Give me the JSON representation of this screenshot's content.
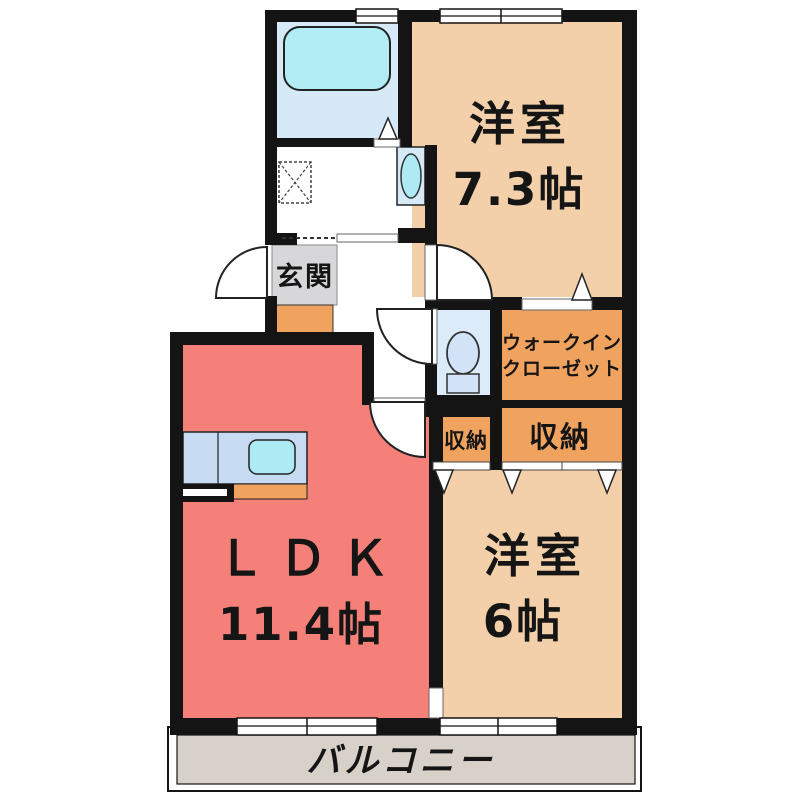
{
  "floor_plan": {
    "rooms": {
      "western_room_73": {
        "name": "洋室",
        "size": "7.3帖"
      },
      "western_room_6": {
        "name": "洋室",
        "size": "6帖"
      },
      "ldk": {
        "name": "ＬＤＫ",
        "size": "11.4帖"
      },
      "walk_in_closet": {
        "name_line1": "ウォークイン",
        "name_line2": "クローゼット"
      },
      "entrance": {
        "name": "玄関"
      },
      "storage_small": {
        "name": "収納"
      },
      "storage_large": {
        "name": "収納"
      },
      "balcony": {
        "name": "バルコニー"
      }
    },
    "colors": {
      "wall": "#141414",
      "room_beige": "#f3d0a9",
      "ldk_salmon": "#f5807a",
      "closet_orange": "#efa35e",
      "entrance_gray": "#d7d7d9",
      "bath_blue": "#d5e9f6",
      "tub_cyan": "#b2ecf5",
      "toilet_room_blue": "#dcebfa",
      "fixture_blue": "#d2e2f7",
      "counter_blue": "#c7dbf3",
      "sink_cyan": "#aeeaf3",
      "balcony_gray": "#d8d1c9",
      "door_white": "#ffffff"
    }
  }
}
